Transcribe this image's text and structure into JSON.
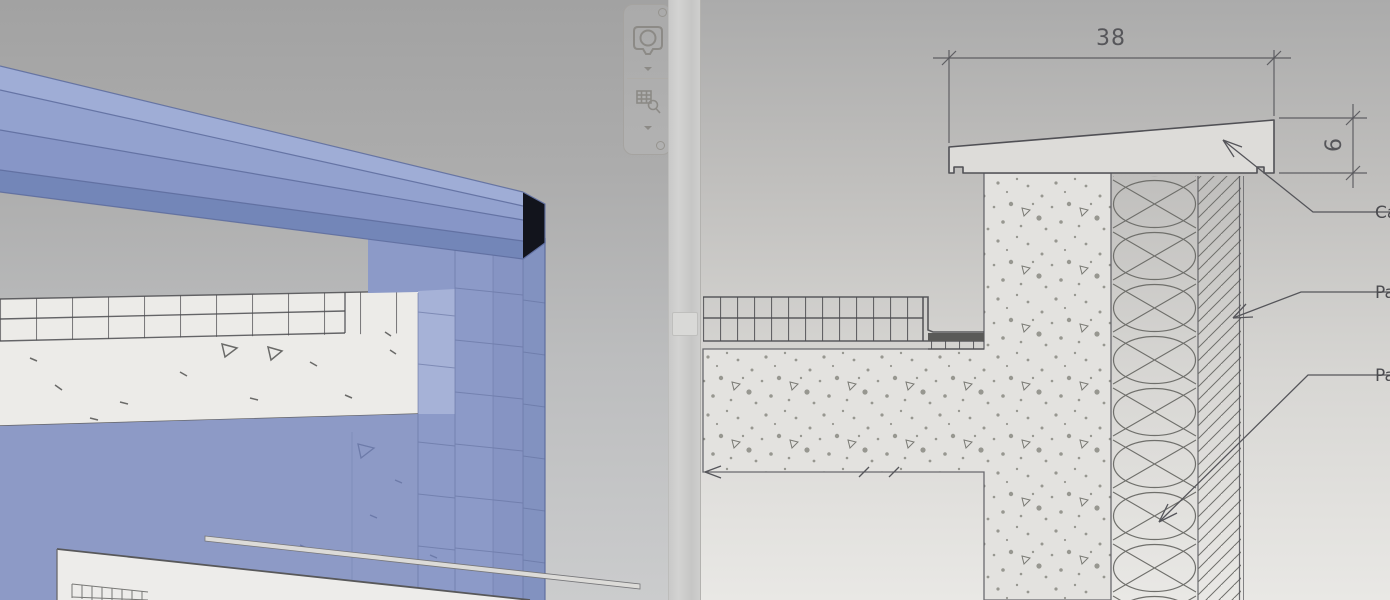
{
  "left_view": {
    "kind": "3d-view",
    "selected_element_hint": "parapet-wall-assembly-highlighted",
    "navigation_bar": {
      "buttons": [
        {
          "icon": "steering-wheel-icon",
          "dropdown_caret": true
        },
        {
          "icon": "zoom-region-icon",
          "dropdown_caret": true
        }
      ]
    }
  },
  "right_view": {
    "kind": "detail-drawing-view",
    "dimensions": [
      {
        "value": "38",
        "orientation": "horizontal"
      },
      {
        "value": "6",
        "orientation": "vertical"
      }
    ],
    "callouts": [
      {
        "label": "Ca",
        "truncated_at_edge": true
      },
      {
        "label": "Pa",
        "truncated_at_edge": true
      },
      {
        "label": "Pa",
        "truncated_at_edge": true
      }
    ],
    "material_patterns": [
      "coping",
      "screed-mesh",
      "concrete-stipple",
      "batt-insulation",
      "diagonal-render-hatch"
    ]
  },
  "colors": {
    "selection_blue": "#8c9ac8",
    "selection_blue_light": "#9fadd6",
    "selection_blue_dark": "#7386b8",
    "drawing_line": "#55555a",
    "bg_left_top": "#a2a2a2",
    "bg_left_bottom": "#cbcccd",
    "bg_right_top": "#ababab",
    "bg_right_bottom": "#e9e8e5"
  }
}
